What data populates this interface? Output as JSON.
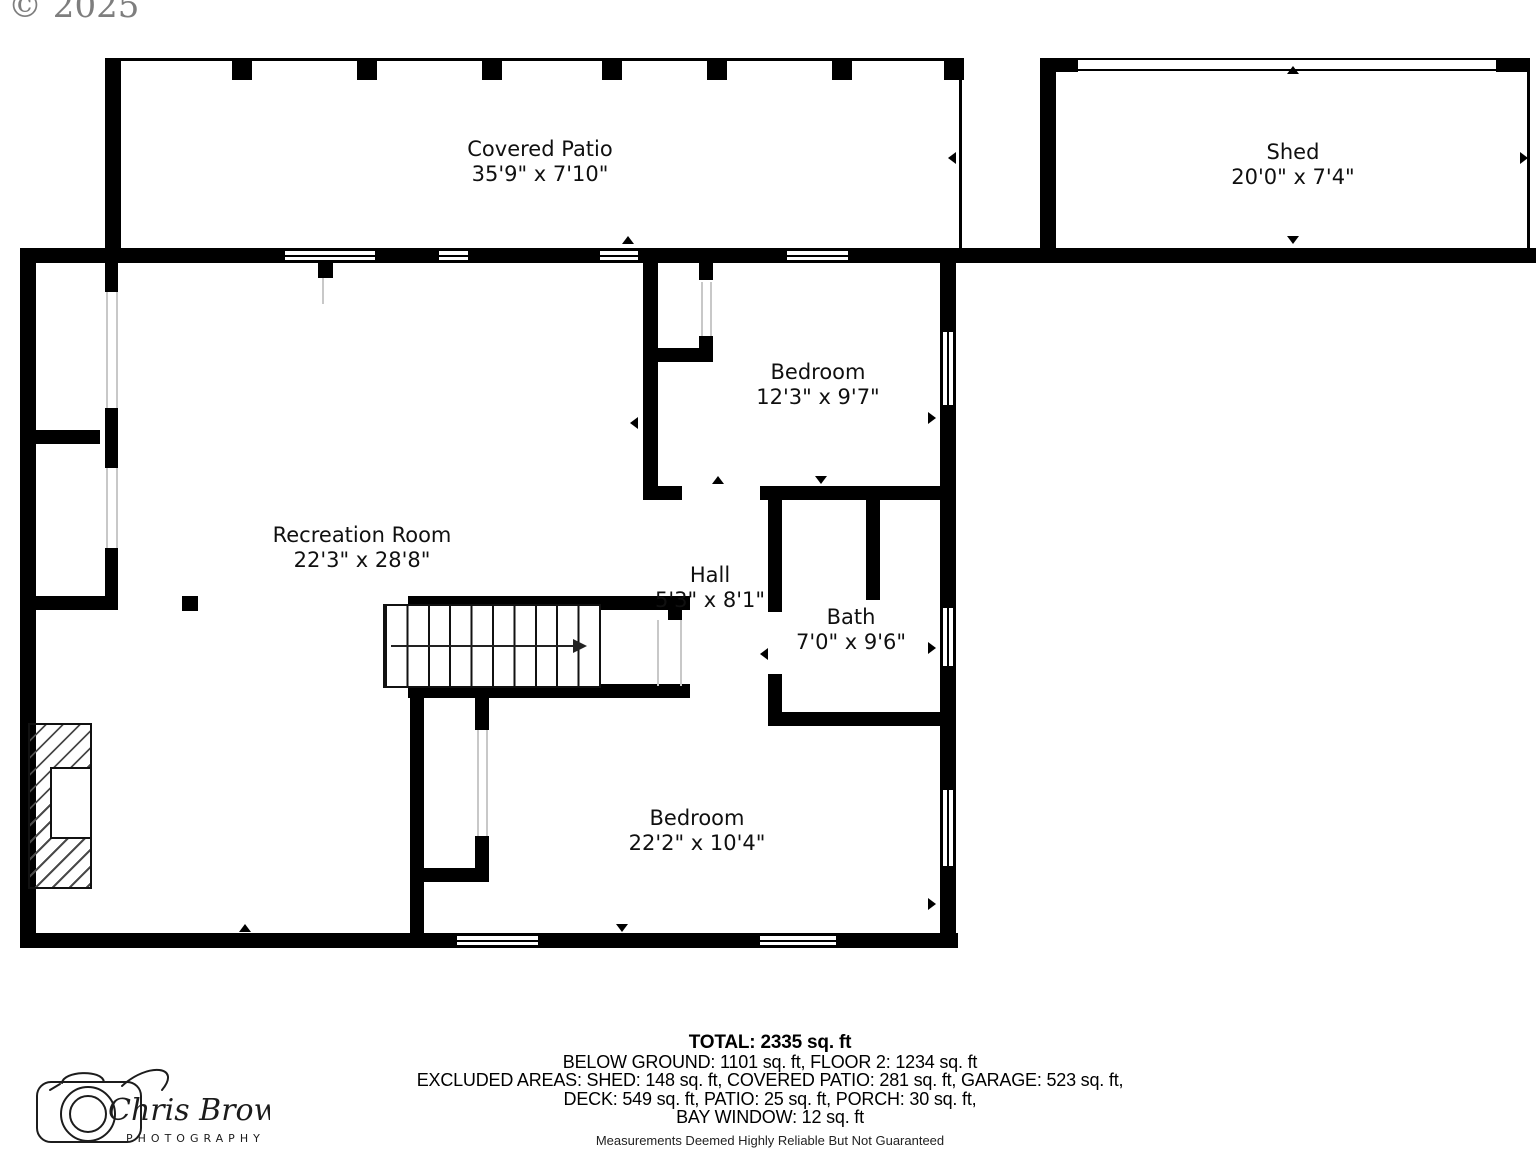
{
  "watermark": {
    "copyright": "© 2025"
  },
  "rooms": [
    {
      "id": "covered-patio",
      "name": "Covered Patio",
      "dims": "35'9\" x 7'10\""
    },
    {
      "id": "shed",
      "name": "Shed",
      "dims": "20'0\" x 7'4\""
    },
    {
      "id": "bedroom-1",
      "name": "Bedroom",
      "dims": "12'3\" x 9'7\""
    },
    {
      "id": "recreation-room",
      "name": "Recreation Room",
      "dims": "22'3\" x 28'8\""
    },
    {
      "id": "hall",
      "name": "Hall",
      "dims": "5'3\" x 8'1\""
    },
    {
      "id": "bath",
      "name": "Bath",
      "dims": "7'0\" x 9'6\""
    },
    {
      "id": "bedroom-2",
      "name": "Bedroom",
      "dims": "22'2\" x 10'4\""
    }
  ],
  "summary": {
    "total": "TOTAL: 2335 sq. ft",
    "line1": "BELOW GROUND: 1101 sq. ft, FLOOR 2: 1234 sq. ft",
    "line2": "EXCLUDED AREAS: SHED: 148 sq. ft, COVERED PATIO: 281 sq. ft, GARAGE: 523 sq. ft,",
    "line3": "DECK: 549 sq. ft, PATIO: 25 sq. ft, PORCH: 30 sq. ft,",
    "line4": "BAY WINDOW: 12 sq. ft",
    "disclaimer": "Measurements Deemed Highly Reliable But Not Guaranteed"
  },
  "logo": {
    "name_script": "Chris Brown",
    "subtitle": "PHOTOGRAPHY"
  },
  "colors": {
    "wall": "#000000",
    "text": "#101010",
    "watermark": "#7e7e7e"
  }
}
